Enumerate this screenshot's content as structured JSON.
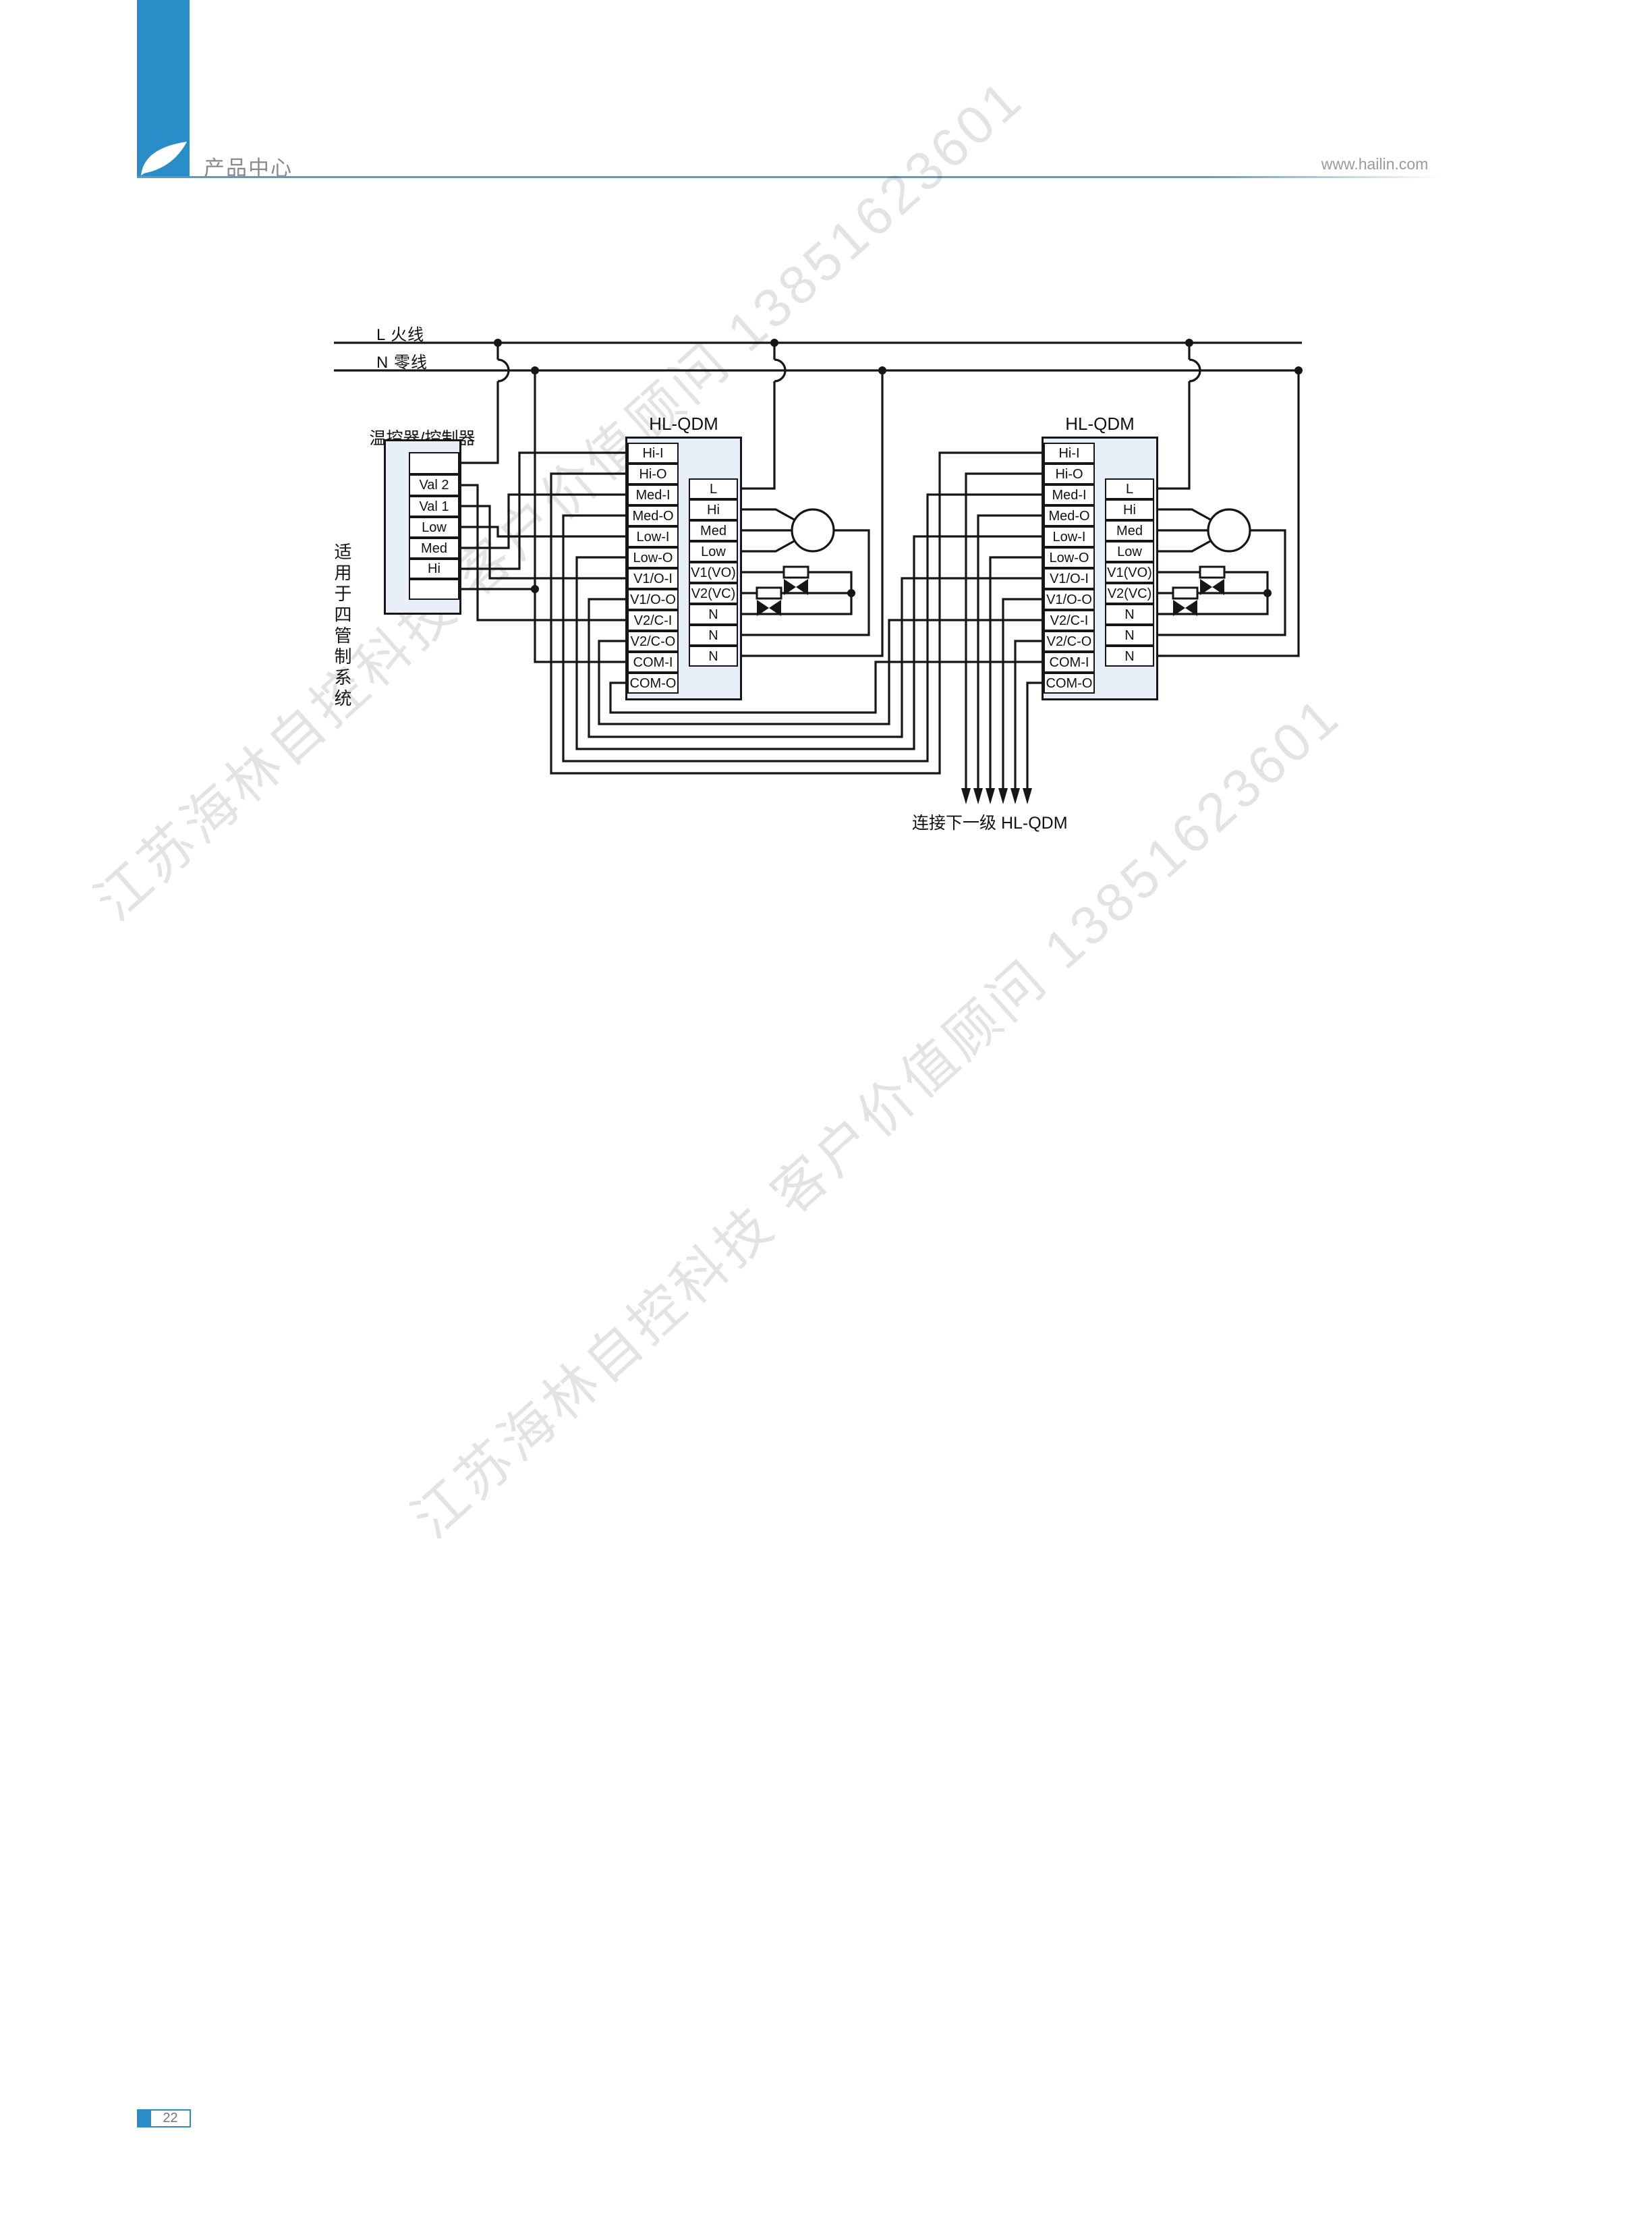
{
  "header": {
    "title": "产品中心",
    "url": "www.hailin.com"
  },
  "side_note": {
    "text": "适用于四管制系统"
  },
  "watermark": {
    "text": "江苏海林自控科技 客户价值顾问 13851623601"
  },
  "diagram": {
    "bus": {
      "live_label": "L 火线",
      "neutral_label": "N 零线"
    },
    "thermostat": {
      "title": "温控器/控制器",
      "cells": [
        "",
        "Val 2",
        "Val 1",
        "Low",
        "Med",
        "Hi",
        ""
      ]
    },
    "blocks": [
      {
        "title": "HL-QDM",
        "left_terminals": [
          "Hi-I",
          "Hi-O",
          "Med-I",
          "Med-O",
          "Low-I",
          "Low-O",
          "V1/O-I",
          "V1/O-O",
          "V2/C-I",
          "V2/C-O",
          "COM-I",
          "COM-O"
        ],
        "right_terminals": [
          "L",
          "Hi",
          "Med",
          "Low",
          "V1(VO)",
          "V2(VC)",
          "N",
          "N",
          "N"
        ]
      },
      {
        "title": "HL-QDM",
        "left_terminals": [
          "Hi-I",
          "Hi-O",
          "Med-I",
          "Med-O",
          "Low-I",
          "Low-O",
          "V1/O-I",
          "V1/O-O",
          "V2/C-I",
          "V2/C-O",
          "COM-I",
          "COM-O"
        ],
        "right_terminals": [
          "L",
          "Hi",
          "Med",
          "Low",
          "V1(VO)",
          "V2(VC)",
          "N",
          "N",
          "N"
        ]
      }
    ],
    "next_stage_note": "连接下一级 HL-QDM"
  },
  "footer": {
    "page_number": "22"
  },
  "colors": {
    "accent": "#2b8dc8",
    "box_fill": "#e9eff9",
    "line": "#161616",
    "gray_text": "#8a8a8a"
  }
}
